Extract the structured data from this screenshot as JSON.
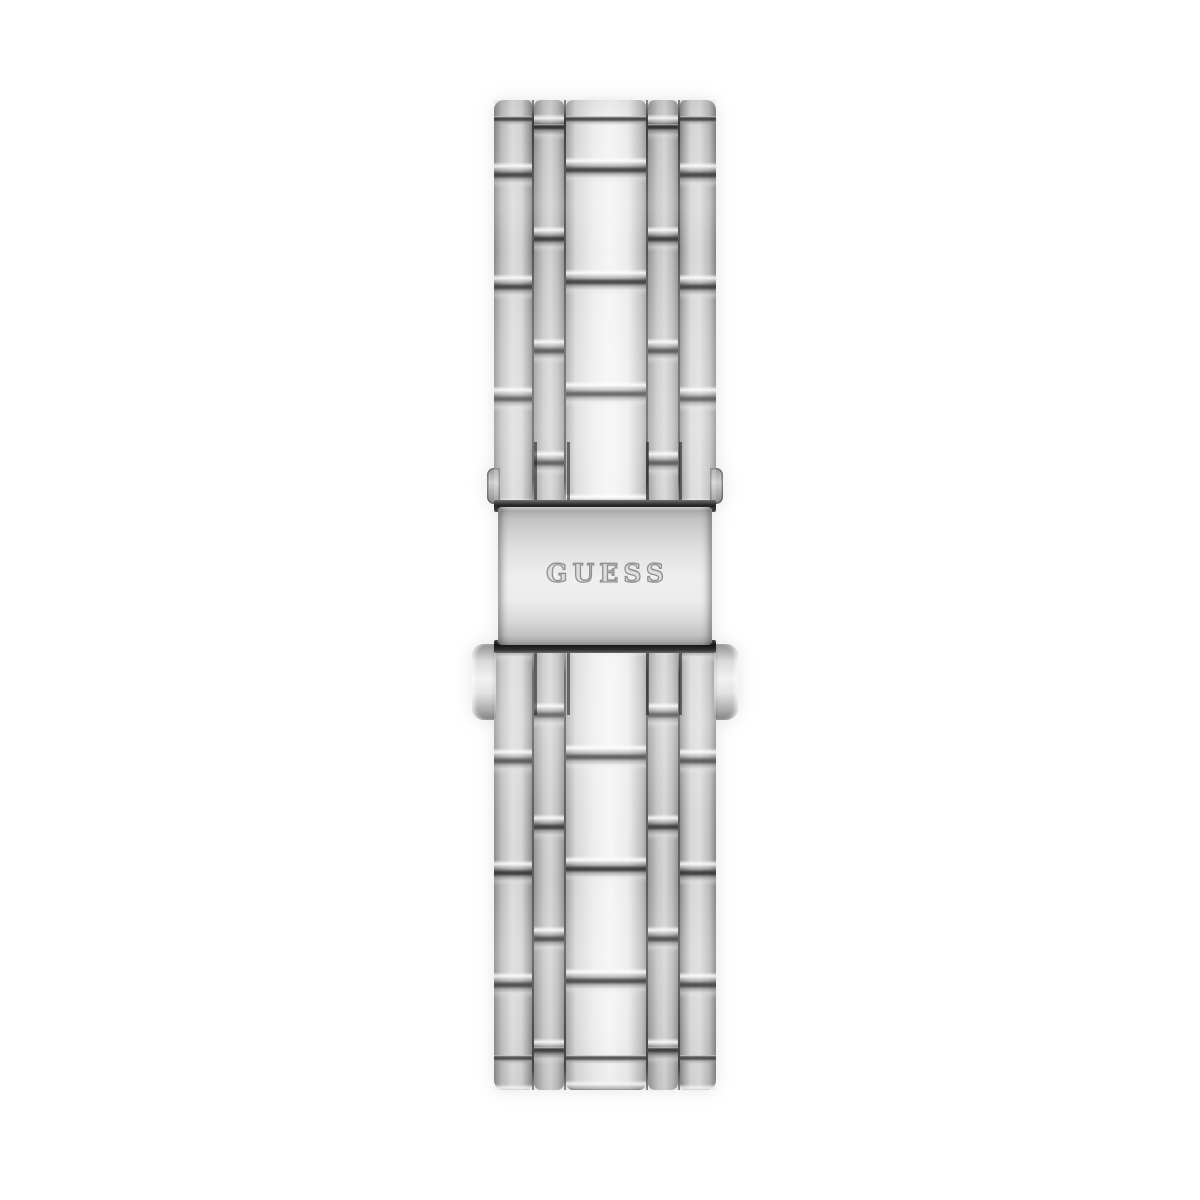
{
  "page": {
    "background_color": "#ffffff"
  },
  "product_photo": {
    "subject": "Silver stainless-steel five-row link watch bracelet, back view",
    "clasp": {
      "type": "fold-over deployment clasp with side push buttons",
      "brand_engraving": "GUESS"
    },
    "colors": {
      "metal_highlight": "#f5f5f5",
      "metal_base": "#c9c9c9",
      "metal_shadow": "#828282",
      "seam_dark": "#2e2e2e",
      "clasp_bar_dark": "#1f1f1f"
    }
  }
}
